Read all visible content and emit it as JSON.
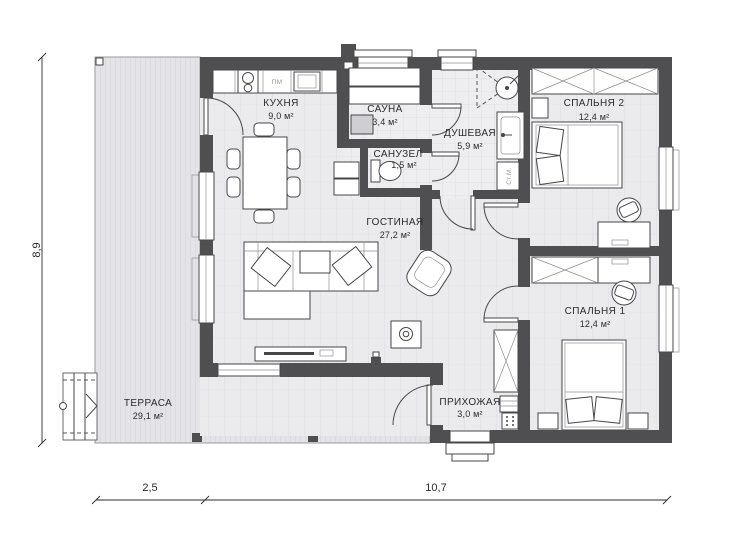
{
  "rooms": {
    "kitchen": {
      "name": "КУХНЯ",
      "area": "9,0 м²"
    },
    "sauna": {
      "name": "САУНА",
      "area": "3,4 м²"
    },
    "bathroom": {
      "name": "САНУЗЕЛ",
      "area": "1,5 м²"
    },
    "shower": {
      "name": "ДУШЕВАЯ",
      "area": "5,9 м²"
    },
    "living": {
      "name": "ГОСТИНАЯ",
      "area": "27,2 м²"
    },
    "bedroom2": {
      "name": "СПАЛЬНЯ 2",
      "area": "12,4 м²"
    },
    "bedroom1": {
      "name": "СПАЛЬНЯ 1",
      "area": "12,4 м²"
    },
    "hallway": {
      "name": "ПРИХОЖАЯ",
      "area": "3,0 м²"
    },
    "terrace": {
      "name": "ТЕРРАСА",
      "area": "29,1 м²"
    }
  },
  "appliances": {
    "dishwasher": "ПМ",
    "washing_machine": "Ст.М."
  },
  "dimensions": {
    "side_height": "8,9",
    "terrace_width": "2,5",
    "house_width": "10,7"
  },
  "colors": {
    "wall": "#4f4f52",
    "floor": "#ebebee",
    "terrace_floor": "#e4e4e8",
    "line": "#47474a"
  }
}
